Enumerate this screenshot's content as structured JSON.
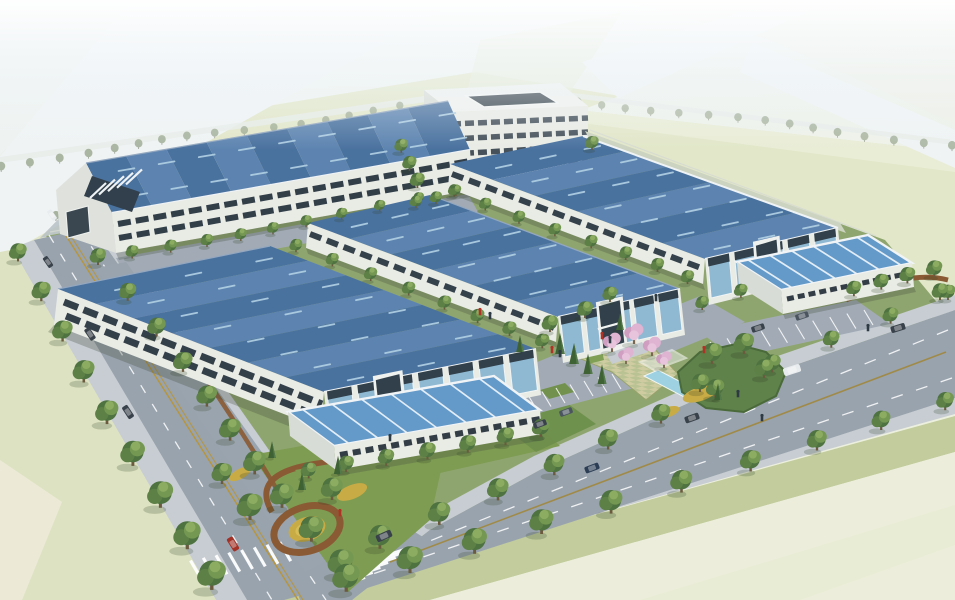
{
  "meta": {
    "image_type": "3D architectural rendering",
    "view": "aerial bird's-eye",
    "description": "Industrial park with four blue-roofed factory halls, a courtyard office block, two single-storey annex halls, landscaped entry plaza, parking and tree-lined avenues"
  },
  "palette": {
    "haze": "#f3f7f9",
    "field_pale": "#eceedb",
    "field_green": "#e2e7c9",
    "field_band": "#e9edd6",
    "field_left": "#dde3c2",
    "distant_road": "#eff3f4",
    "site_grass": "#8fa56f",
    "grass_dark": "#6e8f4c",
    "grass_mid": "#7e9c52",
    "grass_light": "#9cb26b",
    "road": "#99a3ae",
    "road_ext": "#b6bfc4",
    "sidewalk": "#c7cdd3",
    "verge": "#c2cc9d",
    "apron": "#a2abb5",
    "roof_dark": "#4a729f",
    "roof_mid": "#5d84b0",
    "roof_small": "#639ac9",
    "skylight": "#aecde2",
    "eave": "#eff3f5",
    "fascia_gray": "#93a7bf",
    "wall": "#e9ebe5",
    "wall_shade": "#d8dcd6",
    "window": "#35414b",
    "glass": "#8fb9d3",
    "glass_dark": "#31404a",
    "mulch": "#8a5a34",
    "flower_yellow": "#c9ab45",
    "flower_yellow_light": "#d8bc55",
    "flower_pink": "#d9a8c8",
    "hedge": "#4a6a3a",
    "tree": "#5d8046",
    "conifer": "#3f6234",
    "faded_tree": "#9aa78e",
    "water": "#9ed2e2",
    "lane_yellow": "#b89538",
    "marking_white": "#ffffff",
    "shadow": "#44503f",
    "car_dark": "#39424a",
    "car_red": "#a23227",
    "car_white": "#e9ecee",
    "car_blue": "#2c3e55",
    "car_gray": "#4a5560",
    "person_red": "#b03226",
    "person_dark": "#2d3a44"
  },
  "scene": {
    "buildings": {
      "office": {
        "name": "office-block",
        "floors": 4,
        "feature": "central courtyard"
      },
      "factory_halls": [
        {
          "name": "factory-hall-1",
          "storeys": 2,
          "roof": "blue metal with skylight strips",
          "feature": "louvered west entrance"
        },
        {
          "name": "factory-hall-2",
          "storeys": 2,
          "roof": "blue metal with skylight strips",
          "feature": "glass end facade"
        },
        {
          "name": "factory-hall-3",
          "storeys": 2,
          "roof": "blue metal with skylight strips",
          "feature": "glass end facade with entrance portal"
        },
        {
          "name": "factory-hall-4",
          "storeys": 2,
          "roof": "blue metal with skylight strips",
          "feature": "glass end facade"
        }
      ],
      "annex_halls": [
        {
          "name": "annex-hall-south",
          "storeys": 1,
          "roof": "light blue with white strips"
        },
        {
          "name": "annex-hall-east",
          "storeys": 1,
          "roof": "light blue with white strips"
        }
      ]
    },
    "landscape": {
      "plaza": "checker-paved entry plaza",
      "features": [
        "pink flowering trees",
        "water channel with pergola",
        "yellow flower circle",
        "mulch paths",
        "hedge-lined parking",
        "lawn wedges"
      ]
    },
    "roads": {
      "west_avenue": "tree-lined avenue with yellow centre line and zebra crossing",
      "south_avenue": "tree-lined avenue with zebra crossing",
      "distant": "hazy highway junction at horizon"
    },
    "vehicles_visible": 14,
    "pedestrians_visible": 13
  }
}
